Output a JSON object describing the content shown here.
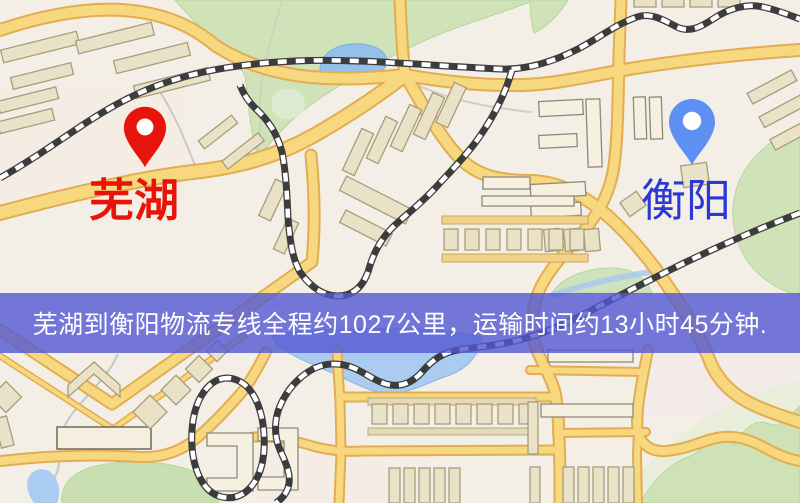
{
  "markers": {
    "origin": {
      "label": "芜湖",
      "icon": "map-pin",
      "pin_color": "#e8140b",
      "label_color": "#e81309"
    },
    "destination": {
      "label": "衡阳",
      "icon": "map-pin",
      "pin_color": "#5e8ff2",
      "label_color": "#2a38d4"
    }
  },
  "banner": {
    "text": "芜湖到衡阳物流专线全程约1027公里，运输时间约13小时45分钟.",
    "background_color": "#5357d3",
    "text_color": "#ffffff"
  },
  "map_colors": {
    "background": "#f4efe6",
    "road_fill": "#f8d87f",
    "road_casing": "#e2ad52",
    "park_green": "#d0e3b8",
    "water_blue": "#a9ccf0",
    "railway_dark": "#3c3c3c",
    "building_beige": "#eae2c6"
  }
}
